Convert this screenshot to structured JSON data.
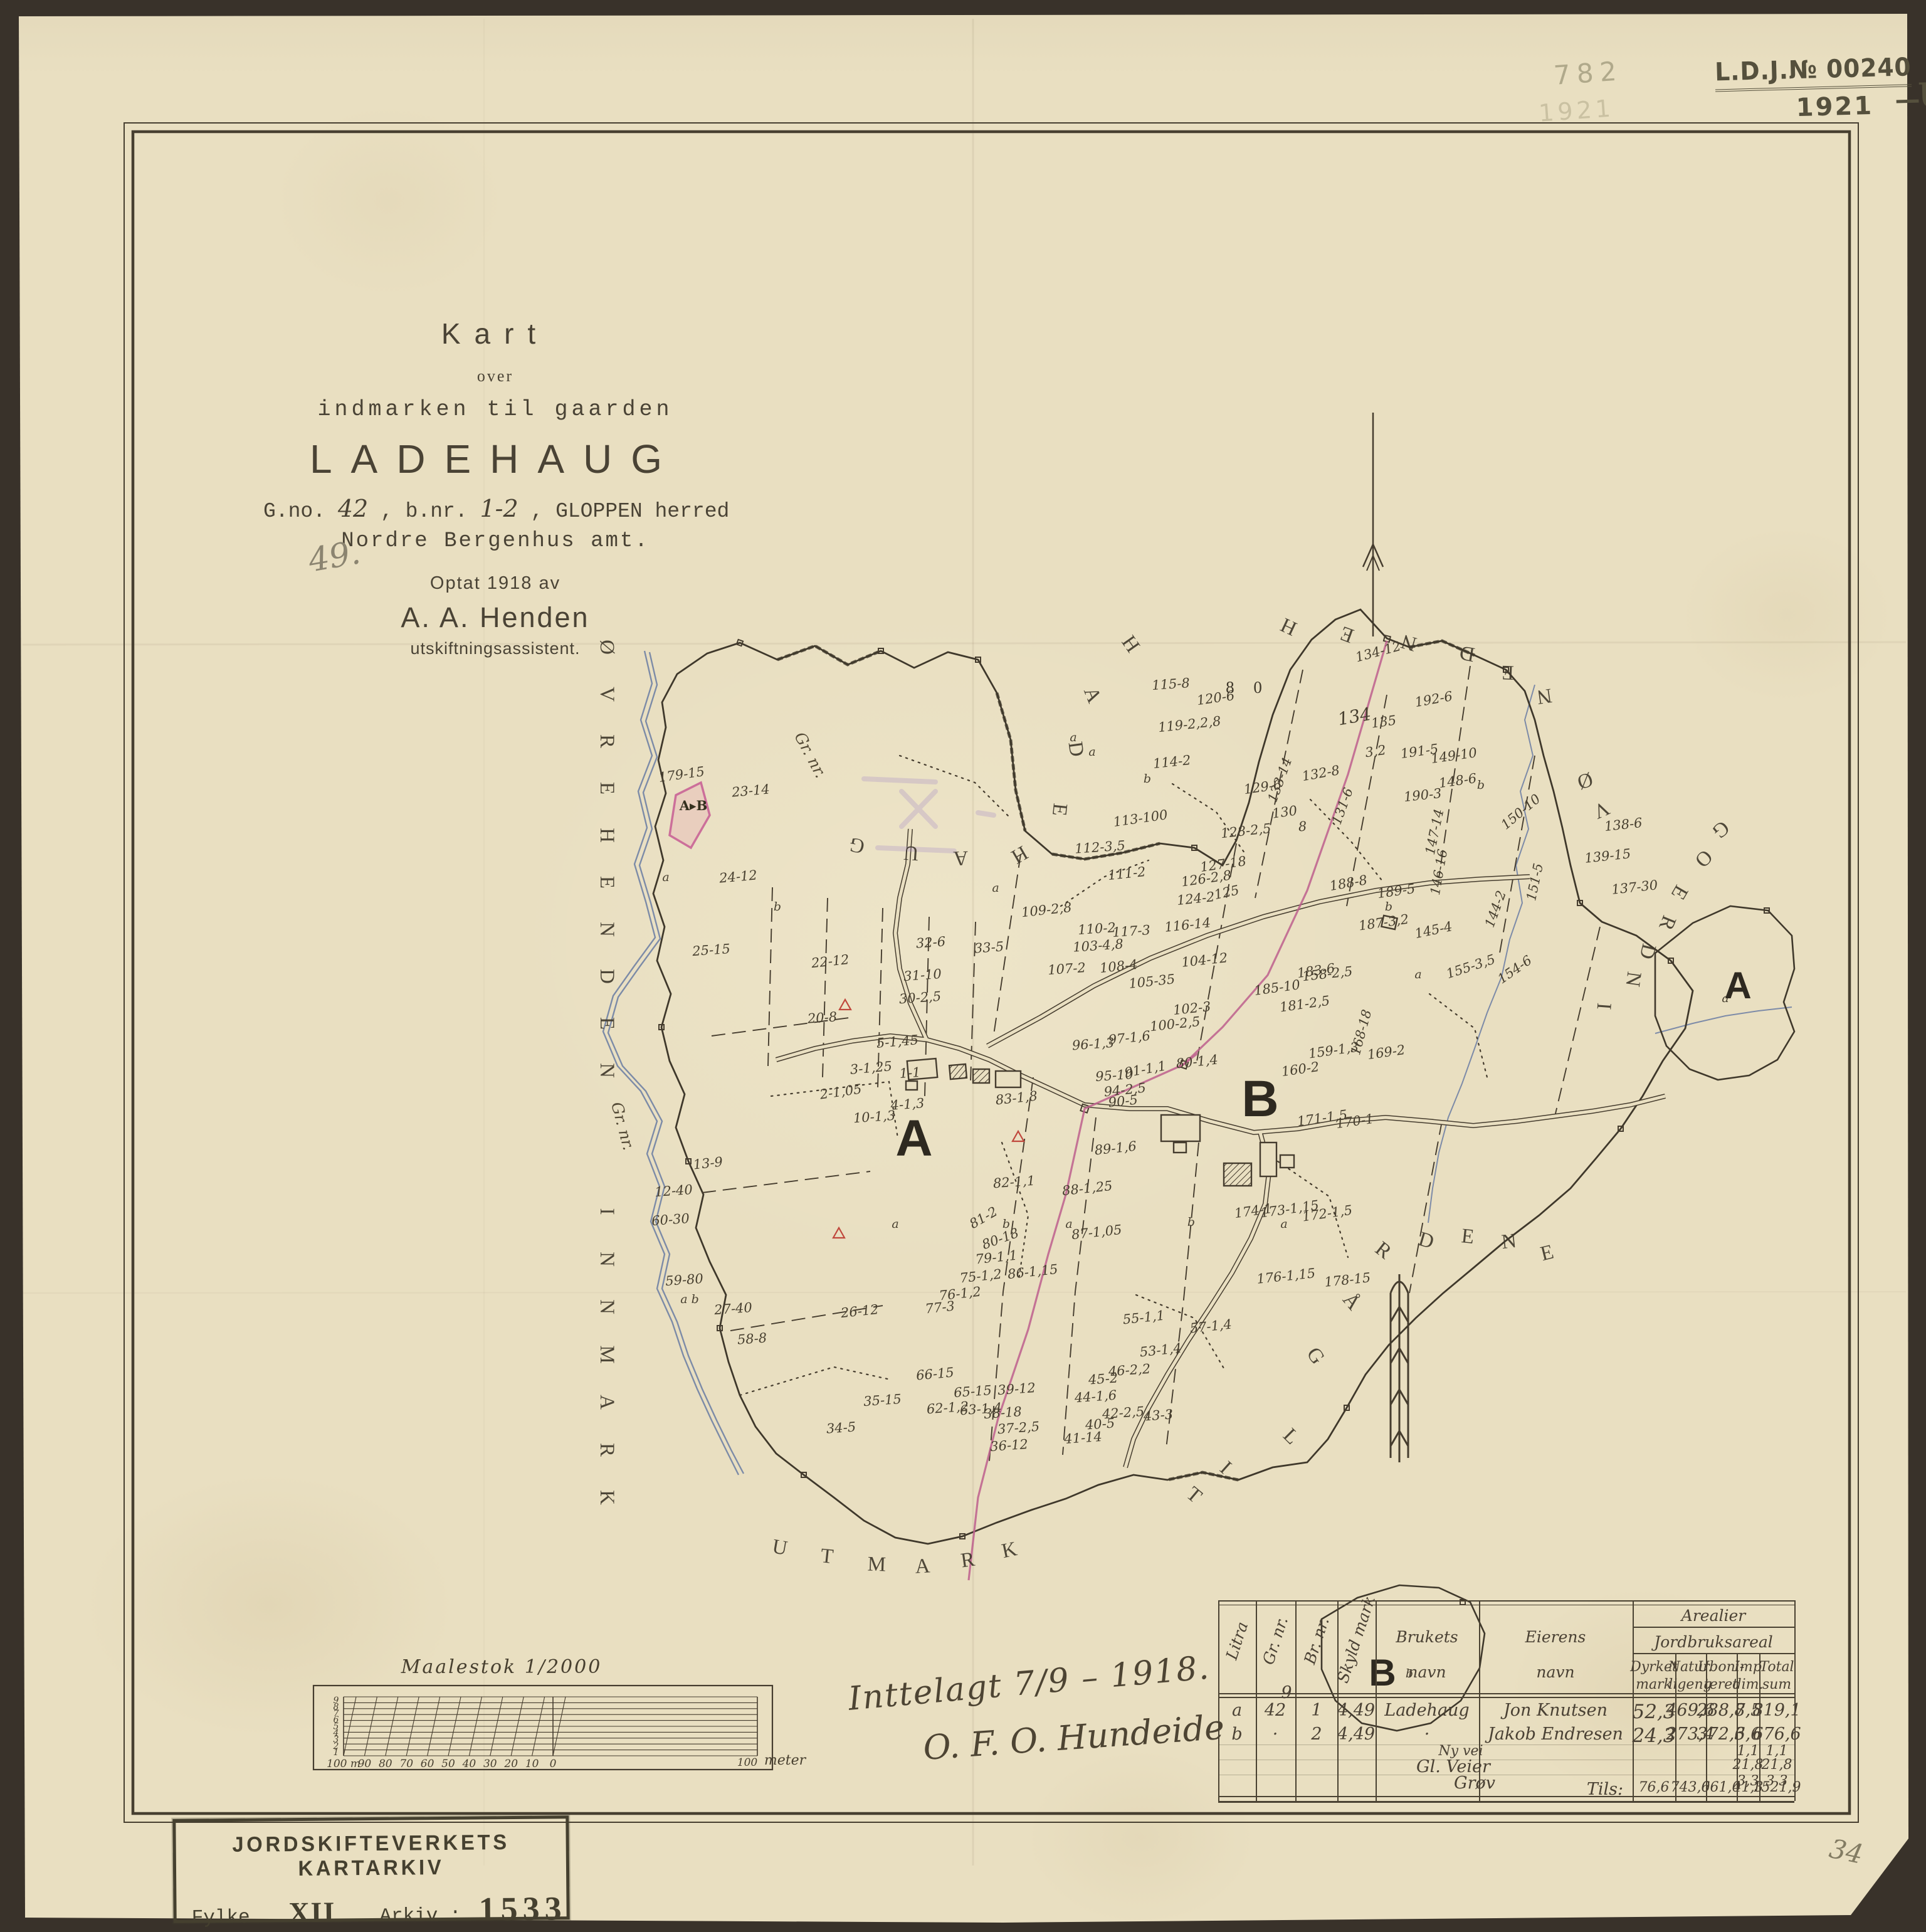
{
  "colors": {
    "bg": "#39322a",
    "paper": "#e9dfc1",
    "ink": "#453c2e",
    "stamp_dark": "#55503d",
    "stamp_faint": "#928c6e",
    "pencil": "#8b8470",
    "pink": "#bd5f8d",
    "blue": "#7182a5",
    "red": "#c0473c",
    "purple": "#a98fc8",
    "archive": "#45402f"
  },
  "title": {
    "kart": "Kart",
    "over": "over",
    "sub": "indmarken til gaarden",
    "name": "LADEHAUG",
    "gno_label": "G.no.",
    "gno": "42",
    "bnr_label": ", b.nr.",
    "bnr": "1-2",
    "herred": ", GLOPPEN herred",
    "amt": "Nordre Bergenhus amt.",
    "optat": "Optat 1918 av",
    "surveyor": "A. A. Henden",
    "role": "utskiftningsassistent."
  },
  "pencil_notes": {
    "left": "49.",
    "corner": "34"
  },
  "stamps": {
    "top_faint": {
      "number": "782",
      "year": "1921"
    },
    "top_dark": {
      "journal": "L.D.J.№ 00240",
      "year": "1921",
      "dash": "—",
      "suffix": "U."
    },
    "archive": {
      "title": "JORDSKIFTEVERKETS KARTARKIV",
      "fylke_label": "Fylke nr.:",
      "fylke": "XII",
      "arkiv_label": "Arkiv.:",
      "arkiv": "1533"
    }
  },
  "signature": {
    "line1": "Inttelagt 7/9 – 1918.",
    "line2": "O. F. O. Hundeide"
  },
  "scalebar": {
    "title": "Maalestok 1/2000",
    "left_ticks": [
      "9",
      "8",
      "7",
      "6",
      "5",
      "4",
      "3",
      "2",
      "1"
    ],
    "bottom_ticks": [
      "100 m",
      "90",
      "80",
      "70",
      "60",
      "50",
      "40",
      "30",
      "20",
      "10",
      "0"
    ],
    "right_tick": "100",
    "unit": "meter"
  },
  "map": {
    "markers": [
      [
        "A",
        1458,
        1843,
        0,
        "B"
      ],
      [
        "B",
        2010,
        1780,
        0,
        "B"
      ],
      [
        "A",
        2772,
        1592,
        0,
        "b2"
      ],
      [
        "B",
        2205,
        2688,
        0,
        "b2"
      ]
    ],
    "region_letters": [
      [
        "Ø",
        958,
        1032,
        90
      ],
      [
        "V",
        958,
        1107,
        90
      ],
      [
        "R",
        958,
        1182,
        90
      ],
      [
        "E",
        958,
        1257,
        90
      ],
      [
        "H",
        958,
        1332,
        90
      ],
      [
        "E",
        958,
        1407,
        90
      ],
      [
        "N",
        958,
        1482,
        90
      ],
      [
        "D",
        958,
        1557,
        90
      ],
      [
        "E",
        958,
        1632,
        90
      ],
      [
        "N",
        958,
        1707,
        90
      ],
      [
        "I",
        958,
        1932,
        90
      ],
      [
        "N",
        958,
        2008,
        90
      ],
      [
        "N",
        958,
        2084,
        90
      ],
      [
        "M",
        958,
        2160,
        90
      ],
      [
        "A",
        958,
        2236,
        90
      ],
      [
        "R",
        958,
        2312,
        90
      ],
      [
        "K",
        958,
        2388,
        90
      ],
      [
        "H",
        1795,
        1033,
        55
      ],
      [
        "A",
        1733,
        1112,
        68
      ],
      [
        "D",
        1706,
        1196,
        82
      ],
      [
        "E",
        1680,
        1290,
        96
      ],
      [
        "H",
        1621,
        1354,
        150
      ],
      [
        "A",
        1532,
        1358,
        178
      ],
      [
        "U",
        1454,
        1350,
        184
      ],
      [
        "G",
        1369,
        1338,
        192
      ],
      [
        "H",
        2060,
        990,
        205
      ],
      [
        "E",
        2152,
        1002,
        200
      ],
      [
        "N",
        2250,
        1015,
        196
      ],
      [
        "D",
        2342,
        1032,
        190
      ],
      [
        "E",
        2405,
        1062,
        182
      ],
      [
        "N",
        2462,
        1100,
        172
      ],
      [
        "Ø",
        2525,
        1235,
        162
      ],
      [
        "V",
        2550,
        1282,
        156
      ],
      [
        "G",
        2738,
        1315,
        140
      ],
      [
        "O",
        2710,
        1362,
        134
      ],
      [
        "E",
        2670,
        1418,
        120
      ],
      [
        "R",
        2650,
        1468,
        112
      ],
      [
        "D",
        2618,
        1515,
        104
      ],
      [
        "N",
        2595,
        1560,
        98
      ],
      [
        "I",
        2548,
        1604,
        94
      ],
      [
        "U",
        1242,
        2478,
        10
      ],
      [
        "T",
        1318,
        2492,
        6
      ],
      [
        "M",
        1398,
        2505,
        2
      ],
      [
        "A",
        1472,
        2508,
        -3
      ],
      [
        "R",
        1545,
        2498,
        -8
      ],
      [
        "K",
        1612,
        2482,
        -12
      ],
      [
        "T",
        1898,
        2392,
        40
      ],
      [
        "I",
        1948,
        2348,
        42
      ],
      [
        "L",
        2052,
        2298,
        45
      ],
      [
        "G",
        2090,
        2168,
        55
      ],
      [
        "Å",
        2148,
        2082,
        50
      ],
      [
        "R",
        2200,
        2002,
        38
      ],
      [
        "D",
        2272,
        1988,
        16
      ],
      [
        "E",
        2340,
        1982,
        6
      ],
      [
        "N",
        2408,
        1990,
        -6
      ],
      [
        "E",
        2470,
        2008,
        -14
      ]
    ],
    "handwritten": [
      [
        "Gr. nr.",
        1285,
        1208,
        62,
        "h"
      ],
      [
        "Gr. nr.",
        985,
        1798,
        75,
        "h"
      ]
    ],
    "labels": [
      [
        "179-15",
        1088,
        1242,
        -8
      ],
      [
        "23-14",
        1198,
        1268,
        -5
      ],
      [
        "A▸B",
        1106,
        1292,
        0,
        "ab"
      ],
      [
        "a",
        1062,
        1405,
        0,
        "i"
      ],
      [
        "24-12",
        1178,
        1405,
        -5
      ],
      [
        "25-15",
        1135,
        1522,
        -4
      ],
      [
        "22-12",
        1325,
        1540,
        -6
      ],
      [
        "32-6",
        1485,
        1510,
        -4
      ],
      [
        "31-10",
        1472,
        1562,
        -4
      ],
      [
        "30-2,5",
        1468,
        1598,
        -4
      ],
      [
        "33-5",
        1578,
        1518,
        -4
      ],
      [
        "20-8",
        1312,
        1630,
        -4
      ],
      [
        "2-1,05",
        1342,
        1748,
        -8
      ],
      [
        "5-1,45",
        1432,
        1668,
        -5
      ],
      [
        "3-1,25",
        1390,
        1710,
        -5
      ],
      [
        "1-1",
        1452,
        1718,
        -4
      ],
      [
        "4-1,3",
        1448,
        1768,
        -4
      ],
      [
        "10-1,3",
        1395,
        1788,
        -4
      ],
      [
        "12-40",
        1075,
        1906,
        -4
      ],
      [
        "13-9",
        1130,
        1862,
        -6
      ],
      [
        "60-30",
        1070,
        1952,
        -4
      ],
      [
        "59-80",
        1092,
        2048,
        -4
      ],
      [
        "a b",
        1100,
        2078,
        0,
        "i"
      ],
      [
        "27-40",
        1170,
        2094,
        -4
      ],
      [
        "58-8",
        1200,
        2142,
        -4
      ],
      [
        "26-12",
        1372,
        2098,
        -6
      ],
      [
        "34-5",
        1342,
        2284,
        -4
      ],
      [
        "35-15",
        1408,
        2240,
        -4
      ],
      [
        "66-15",
        1492,
        2198,
        -5
      ],
      [
        "65-15",
        1552,
        2226,
        -4
      ],
      [
        "39-12",
        1622,
        2222,
        -4
      ],
      [
        "63-1,4",
        1565,
        2254,
        -4
      ],
      [
        "62-1,2",
        1512,
        2252,
        -4
      ],
      [
        "38-18",
        1600,
        2260,
        -4
      ],
      [
        "37-2,5",
        1625,
        2284,
        -4
      ],
      [
        "36-12",
        1610,
        2312,
        -4
      ],
      [
        "44-1,6",
        1748,
        2234,
        -4
      ],
      [
        "45-2",
        1760,
        2206,
        -4
      ],
      [
        "46-2,2",
        1802,
        2192,
        -4
      ],
      [
        "42-2,5",
        1792,
        2260,
        -4
      ],
      [
        "43-3",
        1848,
        2264,
        -4
      ],
      [
        "40-5",
        1755,
        2278,
        -4
      ],
      [
        "41-14",
        1728,
        2300,
        -4
      ],
      [
        "83-1,8",
        1622,
        1758,
        -6
      ],
      [
        "95-10",
        1778,
        1722,
        -4
      ],
      [
        "91-1,1",
        1828,
        1712,
        -10
      ],
      [
        "94-2,5",
        1795,
        1745,
        -6
      ],
      [
        "90-5",
        1792,
        1763,
        -6
      ],
      [
        "80-1,4",
        1910,
        1700,
        -6
      ],
      [
        "97-1,6",
        1802,
        1662,
        -6
      ],
      [
        "96-1,3",
        1744,
        1672,
        -4
      ],
      [
        "102-3",
        1902,
        1615,
        -6
      ],
      [
        "100-2,5",
        1875,
        1640,
        -6
      ],
      [
        "82-1,1",
        1618,
        1892,
        -4
      ],
      [
        "88-1,25",
        1735,
        1902,
        -6
      ],
      [
        "89-1,6",
        1780,
        1838,
        -6
      ],
      [
        "87-1,05",
        1750,
        1972,
        -6
      ],
      [
        "86-1,15",
        1648,
        2035,
        -6
      ],
      [
        "81-2",
        1572,
        1948,
        -30
      ],
      [
        "80-18",
        1598,
        1982,
        -20
      ],
      [
        "79-1,1",
        1590,
        2012,
        -6
      ],
      [
        "75-1,2",
        1565,
        2042,
        -6
      ],
      [
        "76-1,2",
        1532,
        2070,
        -6
      ],
      [
        "77-3",
        1500,
        2092,
        -6
      ],
      [
        "115-8",
        1868,
        1098,
        -4
      ],
      [
        "120-6",
        1940,
        1120,
        -8
      ],
      [
        "119-2,2,8",
        1898,
        1162,
        -6
      ],
      [
        "114-2",
        1870,
        1222,
        -6
      ],
      [
        "113-100",
        1820,
        1312,
        -8
      ],
      [
        "112-3,5",
        1755,
        1358,
        -4
      ],
      [
        "111-2",
        1798,
        1400,
        -6
      ],
      [
        "110-2",
        1750,
        1488,
        -4
      ],
      [
        "109-2,8",
        1670,
        1458,
        -6
      ],
      [
        "117-3",
        1805,
        1492,
        -4
      ],
      [
        "116-14",
        1895,
        1482,
        -6
      ],
      [
        "104-12",
        1922,
        1538,
        -6
      ],
      [
        "108-4",
        1785,
        1548,
        -6
      ],
      [
        "105-35",
        1838,
        1572,
        -6
      ],
      [
        "107-2",
        1702,
        1552,
        -4
      ],
      [
        "103-4,8",
        1752,
        1515,
        -4
      ],
      [
        "8 0",
        1990,
        1105,
        0,
        "sp"
      ],
      [
        "134-12",
        2200,
        1046,
        -15
      ],
      [
        "192-6",
        2288,
        1122,
        -10
      ],
      [
        "134",
        2162,
        1152,
        -10,
        "h2"
      ],
      [
        "135",
        2208,
        1158,
        -8
      ],
      [
        "3,2",
        2195,
        1205,
        -8
      ],
      [
        "191-5",
        2265,
        1205,
        -8
      ],
      [
        "190-3",
        2270,
        1275,
        -6
      ],
      [
        "132-8",
        2108,
        1240,
        -10
      ],
      [
        "133-14",
        2048,
        1246,
        -70
      ],
      [
        "129-6",
        2015,
        1262,
        -8
      ],
      [
        "130",
        2050,
        1302,
        -8
      ],
      [
        "8",
        2078,
        1325,
        -4
      ],
      [
        "131-6",
        2148,
        1288,
        -70
      ],
      [
        "128-2,5",
        1988,
        1332,
        -6
      ],
      [
        "127-18",
        1952,
        1385,
        -8
      ],
      [
        "126-2,8",
        1925,
        1408,
        -8
      ],
      [
        "124-2",
        1908,
        1440,
        -6
      ],
      [
        "125",
        1958,
        1430,
        -12
      ],
      [
        "188-8",
        2152,
        1415,
        -10
      ],
      [
        "189-5",
        2228,
        1428,
        -8
      ],
      [
        "187-3,2",
        2208,
        1478,
        -8
      ],
      [
        "183-6",
        2100,
        1555,
        -8
      ],
      [
        "185-10",
        2038,
        1582,
        -8
      ],
      [
        "181-2,5",
        2082,
        1608,
        -8
      ],
      [
        "158-2,5",
        2118,
        1560,
        -6
      ],
      [
        "159-1,3",
        2128,
        1682,
        -8
      ],
      [
        "160-2",
        2075,
        1712,
        -8
      ],
      [
        "168-18",
        2178,
        1648,
        -75
      ],
      [
        "169-2",
        2212,
        1685,
        -8
      ],
      [
        "149-10",
        2320,
        1212,
        -8
      ],
      [
        "148-6",
        2326,
        1252,
        -8
      ],
      [
        "150-10",
        2430,
        1300,
        -40
      ],
      [
        "147-14",
        2295,
        1328,
        -78
      ],
      [
        "146-16",
        2302,
        1392,
        -80
      ],
      [
        "145-4",
        2288,
        1490,
        -12
      ],
      [
        "144-2",
        2392,
        1452,
        -70
      ],
      [
        "155-3,5",
        2348,
        1548,
        -18
      ],
      [
        "154-6",
        2420,
        1552,
        -35
      ],
      [
        "151-5",
        2455,
        1408,
        -78
      ],
      [
        "139-15",
        2565,
        1372,
        -6
      ],
      [
        "138-6",
        2590,
        1322,
        -6
      ],
      [
        "137-30",
        2608,
        1422,
        -6
      ],
      [
        "171-1,5",
        2110,
        1790,
        -8
      ],
      [
        "170-1",
        2162,
        1795,
        -8
      ],
      [
        "174-1",
        2000,
        1938,
        -8
      ],
      [
        "173-1,15",
        2058,
        1935,
        -8
      ],
      [
        "172-1,5",
        2118,
        1942,
        -8
      ],
      [
        "176-1,15",
        2052,
        2042,
        -6
      ],
      [
        "178-15",
        2150,
        2048,
        -6
      ],
      [
        "57-1,4",
        1932,
        2122,
        -6
      ],
      [
        "55-1,1",
        1825,
        2108,
        -6
      ],
      [
        "53-1,4",
        1852,
        2160,
        -6
      ],
      [
        "a",
        1742,
        1205,
        0,
        "i"
      ],
      [
        "b",
        1830,
        1248,
        0,
        "i"
      ],
      [
        "a",
        1712,
        1182,
        0,
        "i"
      ],
      [
        "a",
        1588,
        1422,
        0,
        "i"
      ],
      [
        "b",
        1240,
        1452,
        0,
        "i"
      ],
      [
        "a",
        1428,
        1958,
        0,
        "i"
      ],
      [
        "b",
        1605,
        1958,
        0,
        "i"
      ],
      [
        "a",
        1705,
        1958,
        0,
        "i"
      ],
      [
        "b",
        1900,
        1955,
        0,
        "i"
      ],
      [
        "a",
        2048,
        1958,
        0,
        "i"
      ],
      [
        "b",
        2215,
        1452,
        0,
        "i"
      ],
      [
        "b",
        2362,
        1258,
        0,
        "i"
      ],
      [
        "a",
        2262,
        1560,
        0,
        "i"
      ],
      [
        "a",
        2752,
        1598,
        0,
        "i"
      ],
      [
        "b",
        2248,
        2675,
        0,
        "i"
      ]
    ]
  },
  "table": {
    "headers": {
      "litra": "Litra",
      "gnr": "Gr. nr.",
      "bnr": "Br. nr.",
      "skyld": "Skyld mark",
      "bruk1": "Brukets",
      "bruk2": "navn",
      "eier1": "Eierens",
      "eier2": "navn",
      "areal": "Arealier",
      "jordbruk": "Jordbruksareal",
      "cols": [
        [
          "Dyrket",
          "mark"
        ],
        [
          "Natur.",
          "ligeng"
        ],
        [
          "Uboni-",
          "teret"
        ],
        [
          "Imp",
          "dim."
        ],
        [
          "Total",
          "sum"
        ]
      ]
    },
    "rows": [
      {
        "litra": "a",
        "gnr": "42",
        "gnr_note": "9",
        "bnr": "1",
        "skyld": "4,49",
        "bruk": "Ladehaug",
        "eier": "Jon Knutsen",
        "vals": [
          "52,3",
          "469,6",
          "288,7",
          "8,5",
          "819,1"
        ]
      },
      {
        "litra": "b",
        "gnr": "·",
        "gnr_note": "",
        "bnr": "2",
        "skyld": "4,49",
        "bruk": "·",
        "eier": "Jakob Endresen",
        "vals": [
          "24,3",
          "273,4",
          "372,3",
          "6,6",
          "676,6"
        ]
      }
    ],
    "extra_rows": [
      {
        "label": "Ny vei",
        "vals": [
          "",
          "",
          "",
          "1,1",
          "1,1"
        ]
      },
      {
        "label": "Gl. Veier",
        "vals": [
          "",
          "",
          "",
          "21,8",
          "21,8"
        ]
      },
      {
        "label": "Grøv",
        "vals": [
          "",
          "",
          "",
          "3,3",
          "3,3"
        ]
      }
    ],
    "totals": {
      "label": "Tils:",
      "vals": [
        "76,6",
        "743,0",
        "661,0",
        "41,3",
        "1521,9"
      ]
    }
  }
}
